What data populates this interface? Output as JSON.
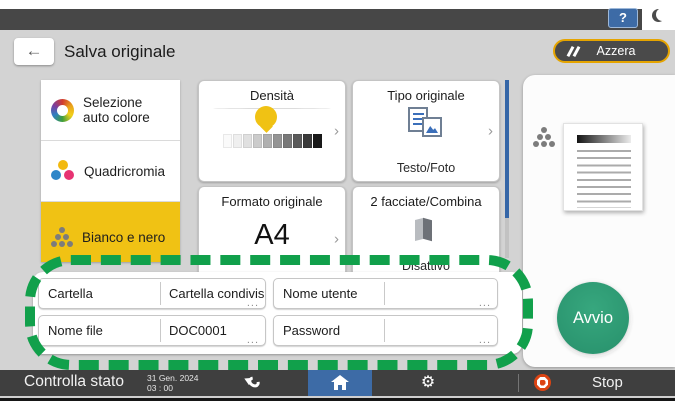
{
  "topbar": {
    "help_label": "?"
  },
  "header": {
    "title": "Salva originale",
    "clear_label": "Azzera"
  },
  "icons": {
    "back_arrow": "←",
    "chevron": "›",
    "gear": "⚙"
  },
  "color_modes": [
    {
      "label": "Selezione auto colore",
      "selected": false
    },
    {
      "label": "Quadricromia",
      "selected": false
    },
    {
      "label": "Bianco e nero",
      "selected": true
    }
  ],
  "cards": {
    "density": {
      "title": "Densità",
      "levels": 10,
      "selected_level": 5
    },
    "original_type": {
      "title": "Tipo originale",
      "value": "Testo/Foto"
    },
    "original_size": {
      "title": "Formato originale",
      "value": "A4"
    },
    "duplex_combine": {
      "title": "2 facciate/Combina",
      "value": "Disattivo"
    }
  },
  "fields": [
    {
      "label": "Cartella",
      "value": "Cartella condivis...",
      "more": "..."
    },
    {
      "label": "Nome utente",
      "value": "",
      "more": "..."
    },
    {
      "label": "Nome file",
      "value": "DOC0001",
      "more": "..."
    },
    {
      "label": "Password",
      "value": "",
      "more": "..."
    }
  ],
  "start_label": "Avvio",
  "statusbar": {
    "check_status": "Controlla stato",
    "date": "31 Gen. 2024",
    "time": "03 : 00",
    "stop_label": "Stop"
  },
  "colors": {
    "selected_yellow": "#f0c214",
    "clear_border_orange": "#e5a400",
    "start_green": "#2f9e78",
    "annotation_green": "#11a04b",
    "home_blue": "#3d6ba6",
    "stop_red": "#dc4413"
  }
}
